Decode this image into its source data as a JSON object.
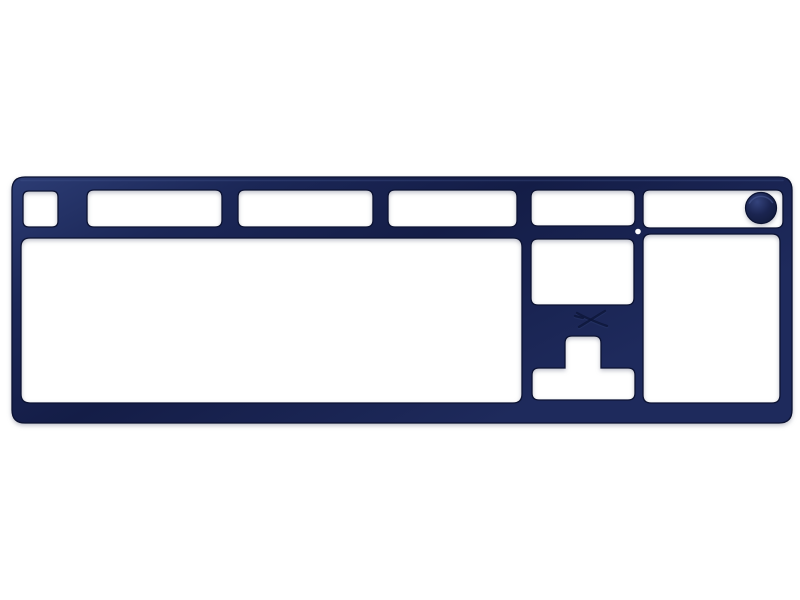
{
  "scene": {
    "type": "product-photo",
    "subject": "Navy blue HyperX full-size keyboard top frame (faceplate) with key-block cutouts and volume wheel, on a plain white background",
    "background": "#ffffff"
  },
  "colors": {
    "background": "#ffffff",
    "plate_highlight": "#2c3c74",
    "plate_mid": "#1b2757",
    "plate_dark": "#141d47",
    "plate_mid2": "#1e2a5c",
    "outline": "#0b1232",
    "top_sheen": "#44568f",
    "knob_light": "#34437c",
    "knob_mid": "#1a2450",
    "knob_dark": "#101938",
    "knob_sheen": "#4a5c97",
    "indicator_dot": "#ffffff",
    "logo_dark": "#0d1538",
    "logo_emboss": "#2e3c6f"
  },
  "parts": {
    "frame": "keyboard-top-frame",
    "cutouts": [
      {
        "name": "esc-key-cutout"
      },
      {
        "name": "f1-f4-keys-cutout"
      },
      {
        "name": "f5-f8-keys-cutout"
      },
      {
        "name": "f9-f12-keys-cutout"
      },
      {
        "name": "system-keys-cutout"
      },
      {
        "name": "media-keys-cutout"
      },
      {
        "name": "main-key-block-cutout"
      },
      {
        "name": "nav-cluster-cutout"
      },
      {
        "name": "arrow-keys-cutout"
      },
      {
        "name": "numpad-cutout"
      }
    ],
    "volume_knob": "volume-wheel",
    "indicator": "status-led-hole",
    "logo": "hyperx-hx-logo"
  }
}
